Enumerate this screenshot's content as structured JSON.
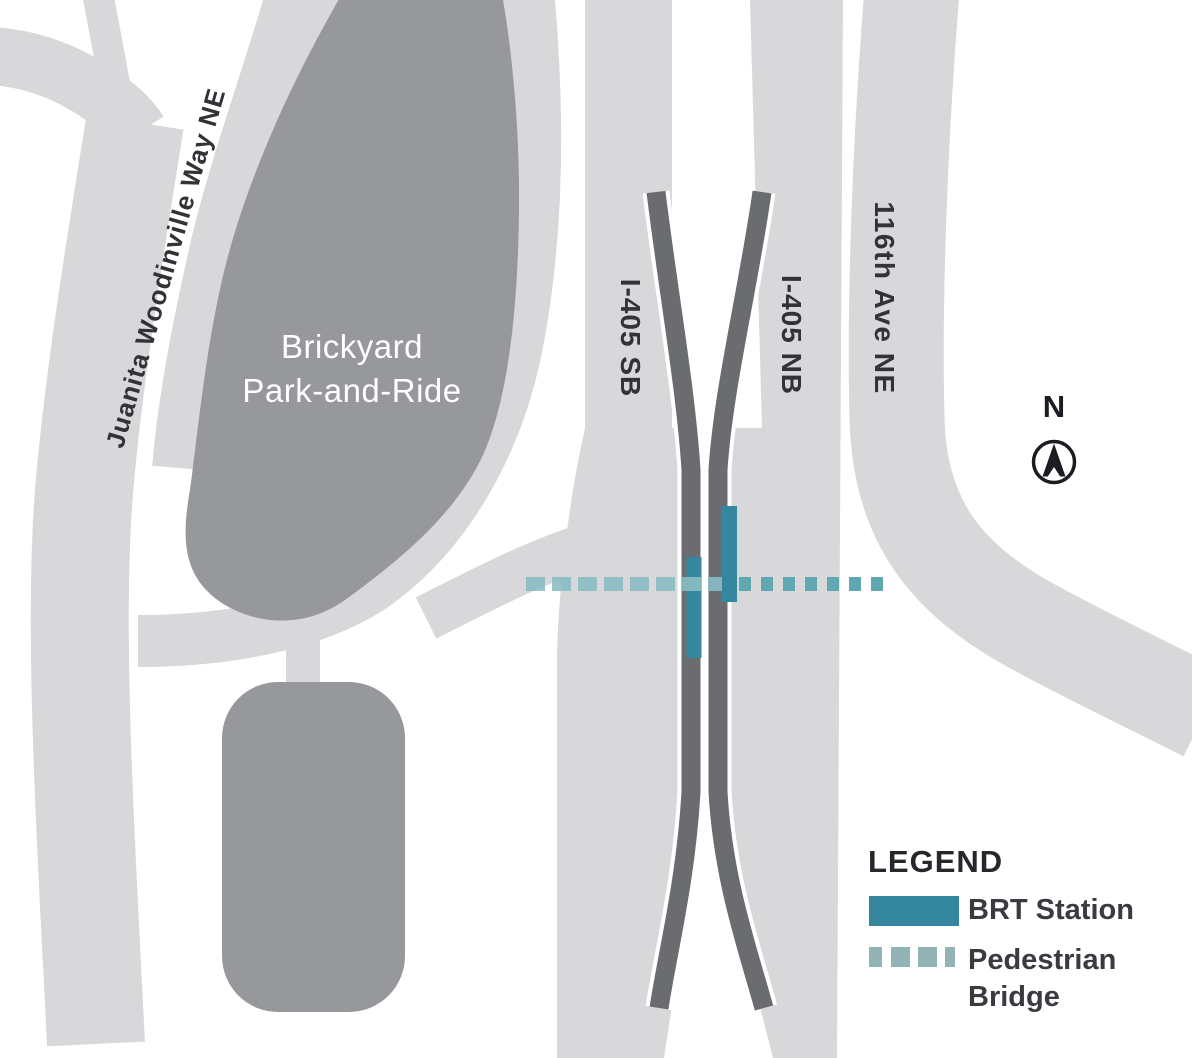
{
  "map": {
    "labels": {
      "juanita": "Juanita Woodinville Way NE",
      "brickyard_line1": "Brickyard",
      "brickyard_line2": "Park-and-Ride",
      "i405_sb": "I-405 SB",
      "i405_nb": "I-405 NB",
      "ave_116": "116th Ave NE",
      "north": "N"
    },
    "legend": {
      "title": "LEGEND",
      "brt_label": "BRT Station",
      "ped_label_line1": "Pedestrian",
      "ped_label_line2": "Bridge"
    },
    "colors": {
      "road_light": "#d8d8da",
      "lot_dark": "#97989b",
      "lane_dark": "#6a6c6f",
      "brt_teal": "#34879e",
      "ped_teal_west": "#8abcc2",
      "ped_teal_east": "#5fa8b2",
      "ped_teal_legend": "#93b4b6",
      "compass_dark": "#1c1d22",
      "white": "#ffffff"
    }
  }
}
